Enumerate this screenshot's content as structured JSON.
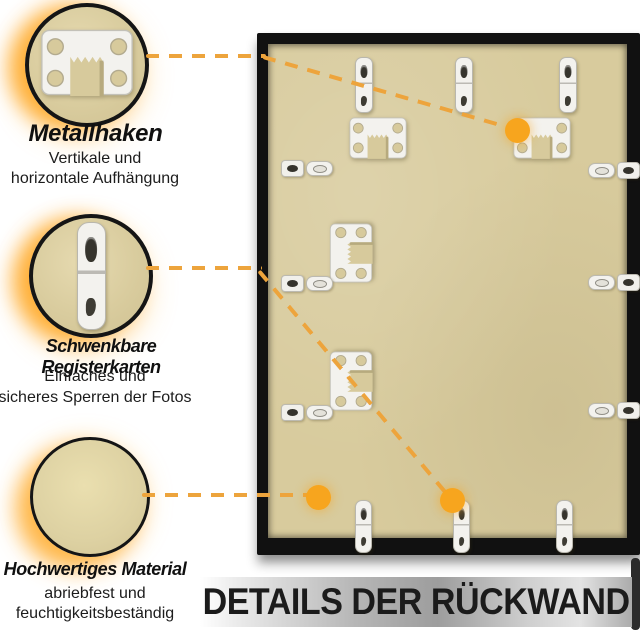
{
  "callouts": [
    {
      "id": "metal-hook",
      "icon": "sawtooth-hanger",
      "title": "Metallhaken",
      "description_lines": [
        "Vertikale und",
        "horizontale Aufhängung"
      ]
    },
    {
      "id": "swivel-tabs",
      "icon": "swivel-tab",
      "title": "Schwenkbare Registerkarten",
      "description_lines": [
        "Einfaches und",
        "sicheres Sperren der Fotos"
      ]
    },
    {
      "id": "material",
      "icon": "material-swatch",
      "title": "Hochwertiges Material",
      "description_lines": [
        "abriebfest und",
        "feuchtigkeitsbeständig"
      ]
    }
  ],
  "banner": {
    "text": "DETAILS DER RÜCKWAND"
  },
  "colors": {
    "accent_dash": "#EDA43C",
    "accent_dot": "#F7A51E",
    "glow": "#FFAE2E",
    "board_beige": "#D8CB9D",
    "frame_black": "#111111",
    "banner_text": "#1B1B1B",
    "banner_end_bar": "#2B2B2B"
  }
}
